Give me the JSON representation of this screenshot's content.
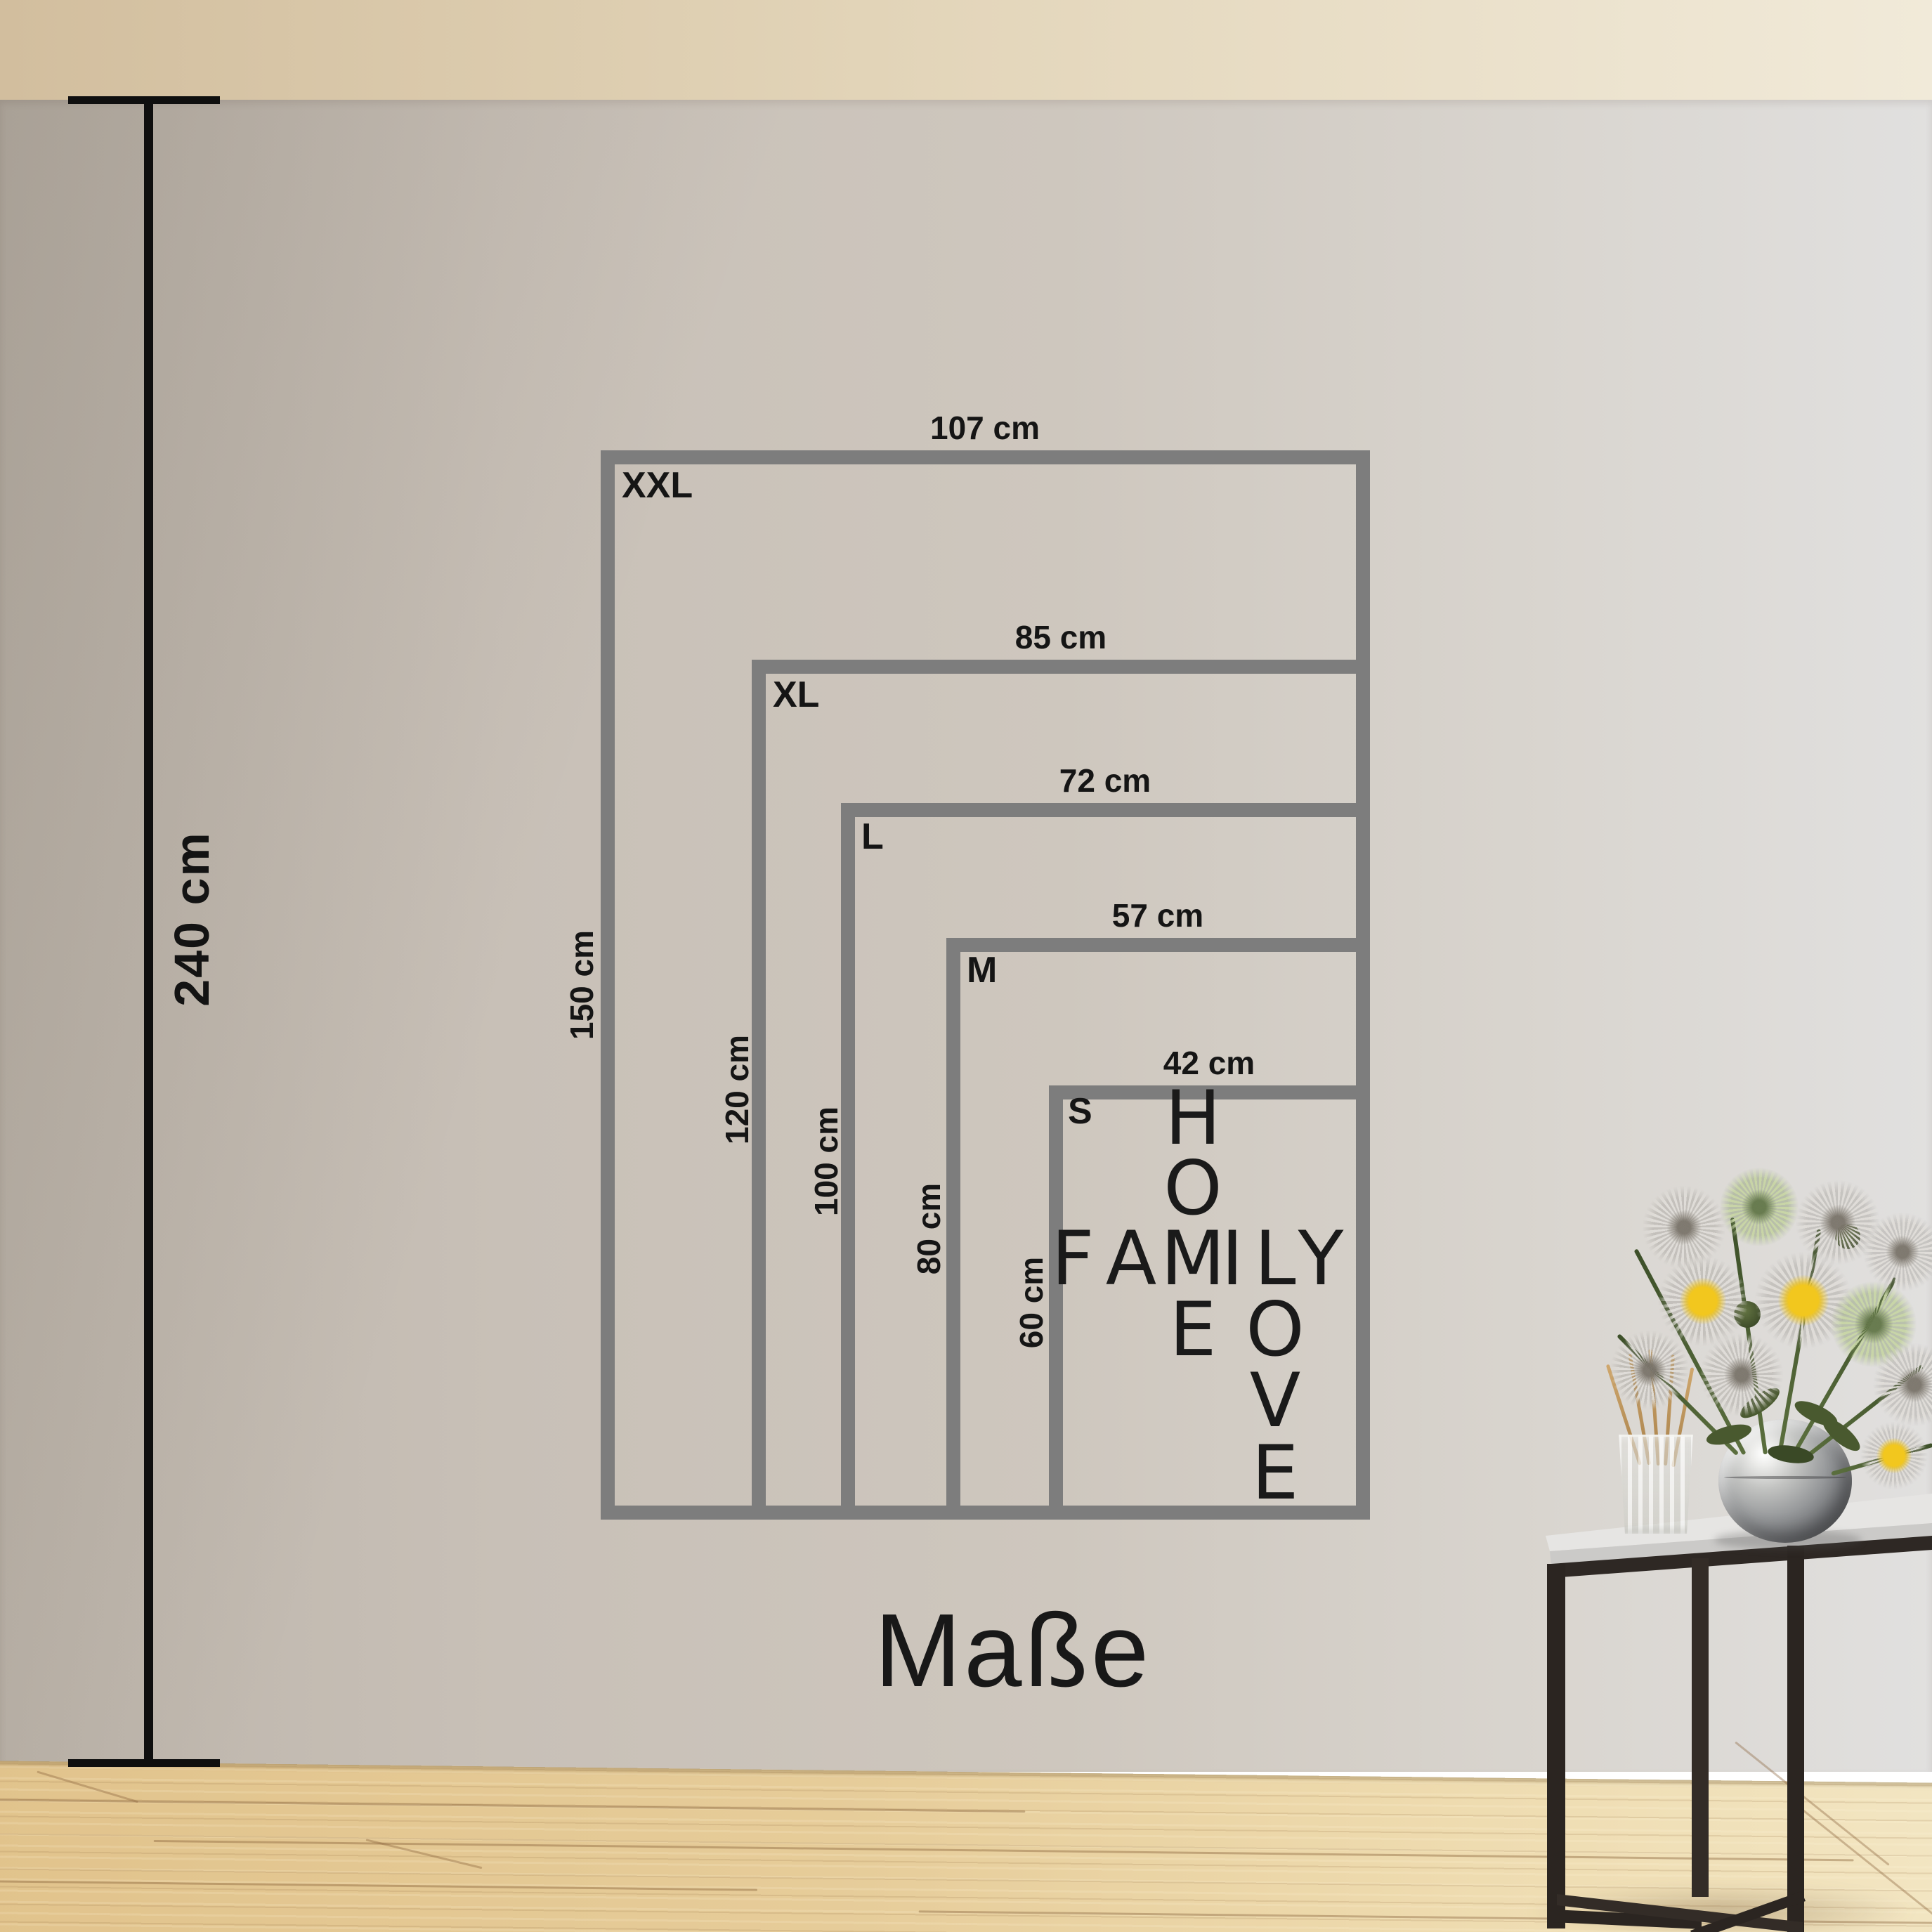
{
  "title": "Maße",
  "measure": {
    "label": "240 cm"
  },
  "frames": [
    {
      "size": "XXL",
      "width": "107 cm",
      "height": "150 cm"
    },
    {
      "size": "XL",
      "width": "85 cm",
      "height": "120 cm"
    },
    {
      "size": "L",
      "width": "72 cm",
      "height": "100 cm"
    },
    {
      "size": "M",
      "width": "57 cm",
      "height": "80 cm"
    },
    {
      "size": "S",
      "width": "42 cm",
      "height": "60 cm"
    }
  ],
  "wordart": {
    "words": [
      "HOME",
      "FAMILY",
      "LOVE"
    ],
    "letters": [
      "H",
      "O",
      "E",
      "F",
      "A",
      "M",
      "I",
      "L",
      "Y",
      "O",
      "V",
      "E"
    ]
  },
  "colors": {
    "frame_gray": "#7d7d7d",
    "text_black": "#151515",
    "ceiling": "#e2d4b8",
    "wall_left": "#bcb4aa",
    "wall_right": "#e1e0df",
    "floor_wood": "#e6cc99",
    "table_metal": "#2b2521",
    "flower_yellow": "#f2c71e"
  }
}
